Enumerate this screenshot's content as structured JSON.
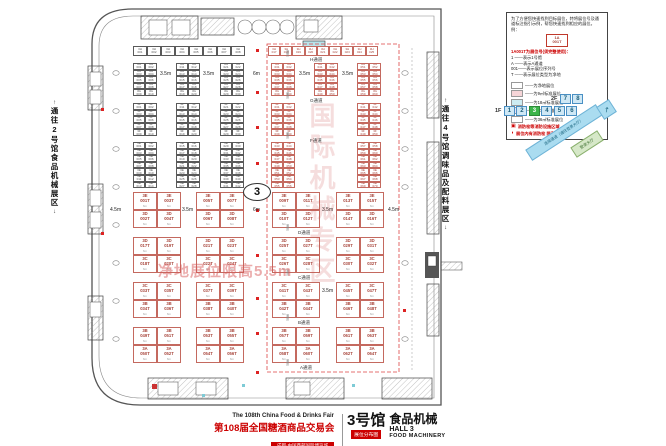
{
  "corridors": {
    "left": "通往2号馆食品机械展区",
    "right": "通往4号馆调味品及配料展区",
    "up": "↑",
    "down": "↓"
  },
  "watermarks": {
    "vertical": "国际机械专区",
    "horizontal": "净地展位限高5.5m"
  },
  "map": {
    "badge": "3",
    "small_blocks": [
      {
        "x": 133,
        "y": 46,
        "cols": 8,
        "rows": 1,
        "cw": 14,
        "ch": 10,
        "cls": "bk",
        "prefix": "3H",
        "start": 1
      },
      {
        "x": 268,
        "y": 46,
        "cols": 9,
        "rows": 1,
        "cw": 12.2,
        "ch": 10,
        "cls": "rd",
        "prefix": "3H",
        "start": 17
      },
      {
        "x": 133,
        "y": 63,
        "cols": 2,
        "rows": 5,
        "cw": 12,
        "ch": 6.6,
        "cls": "bk",
        "prefix": "3G",
        "start": 1
      },
      {
        "x": 176,
        "y": 63,
        "cols": 2,
        "rows": 5,
        "cw": 12,
        "ch": 6.6,
        "cls": "bk",
        "prefix": "3G",
        "start": 11
      },
      {
        "x": 220,
        "y": 63,
        "cols": 2,
        "rows": 5,
        "cw": 12,
        "ch": 6.6,
        "cls": "bk",
        "prefix": "3G",
        "start": 21
      },
      {
        "x": 271,
        "y": 63,
        "cols": 2,
        "rows": 5,
        "cw": 12,
        "ch": 6.6,
        "cls": "rd",
        "prefix": "3G",
        "start": 31
      },
      {
        "x": 314,
        "y": 63,
        "cols": 2,
        "rows": 5,
        "cw": 12,
        "ch": 6.6,
        "cls": "rd",
        "prefix": "3G",
        "start": 41
      },
      {
        "x": 357,
        "y": 63,
        "cols": 2,
        "rows": 5,
        "cw": 12,
        "ch": 6.6,
        "cls": "rd",
        "prefix": "3G",
        "start": 51
      },
      {
        "x": 133,
        "y": 103,
        "cols": 2,
        "rows": 5,
        "cw": 12,
        "ch": 6.6,
        "cls": "bk",
        "prefix": "3F",
        "start": 1
      },
      {
        "x": 176,
        "y": 103,
        "cols": 2,
        "rows": 5,
        "cw": 12,
        "ch": 6.6,
        "cls": "bk",
        "prefix": "3F",
        "start": 11
      },
      {
        "x": 220,
        "y": 103,
        "cols": 2,
        "rows": 5,
        "cw": 12,
        "ch": 6.6,
        "cls": "bk",
        "prefix": "3F",
        "start": 21
      },
      {
        "x": 271,
        "y": 103,
        "cols": 2,
        "rows": 5,
        "cw": 12,
        "ch": 6.6,
        "cls": "rd",
        "prefix": "3F",
        "start": 31
      },
      {
        "x": 357,
        "y": 103,
        "cols": 2,
        "rows": 5,
        "cw": 12,
        "ch": 6.6,
        "cls": "rd",
        "prefix": "3F",
        "start": 41
      },
      {
        "x": 133,
        "y": 142,
        "cols": 2,
        "rows": 7,
        "cw": 12,
        "ch": 6.6,
        "cls": "bk",
        "prefix": "3E",
        "start": 1
      },
      {
        "x": 176,
        "y": 142,
        "cols": 2,
        "rows": 7,
        "cw": 12,
        "ch": 6.6,
        "cls": "bk",
        "prefix": "3E",
        "start": 15
      },
      {
        "x": 220,
        "y": 142,
        "cols": 2,
        "rows": 7,
        "cw": 12,
        "ch": 6.6,
        "cls": "bk",
        "prefix": "3E",
        "start": 29
      },
      {
        "x": 271,
        "y": 142,
        "cols": 2,
        "rows": 7,
        "cw": 12,
        "ch": 6.6,
        "cls": "rd",
        "prefix": "3E",
        "start": 43
      },
      {
        "x": 357,
        "y": 142,
        "cols": 2,
        "rows": 7,
        "cw": 12,
        "ch": 6.6,
        "cls": "rd",
        "prefix": "3E",
        "start": 57
      }
    ],
    "big_cols": [
      133,
      157,
      196,
      220,
      272,
      296,
      336,
      360
    ],
    "big_w": 24,
    "big_h": 18,
    "big_size_note": "6m",
    "big_bands": [
      {
        "y": 192,
        "rows": [
          "3E",
          "3D"
        ],
        "base": 1
      },
      {
        "y": 237,
        "rows": [
          "3D",
          "3C"
        ],
        "base": 17
      },
      {
        "y": 282,
        "rows": [
          "3C",
          "3B"
        ],
        "base": 33
      },
      {
        "y": 327,
        "rows": [
          "3B",
          "3A"
        ],
        "base": 49
      }
    ],
    "aisles": [
      {
        "label": "H通道",
        "x": 310,
        "y": 57
      },
      {
        "label": "G通道",
        "x": 310,
        "y": 98
      },
      {
        "label": "F通道",
        "x": 310,
        "y": 138
      },
      {
        "label": "D通道",
        "x": 298,
        "y": 230
      },
      {
        "label": "C通道",
        "x": 298,
        "y": 275
      },
      {
        "label": "B通道",
        "x": 298,
        "y": 320
      },
      {
        "label": "A通道",
        "x": 300,
        "y": 365
      },
      {
        "label": "通道",
        "x": 285,
        "y": 50,
        "rot": true
      },
      {
        "label": "通道",
        "x": 285,
        "y": 92,
        "rot": true
      },
      {
        "label": "通道",
        "x": 285,
        "y": 132,
        "rot": true
      },
      {
        "label": "通道",
        "x": 285,
        "y": 224,
        "rot": true
      },
      {
        "label": "通道",
        "x": 285,
        "y": 269,
        "rot": true
      },
      {
        "label": "通道",
        "x": 285,
        "y": 314,
        "rot": true
      },
      {
        "label": "通道",
        "x": 285,
        "y": 359,
        "rot": true
      }
    ],
    "dims": [
      {
        "t": "3.5m",
        "x": 160,
        "y": 71
      },
      {
        "t": "3.5m",
        "x": 203,
        "y": 71
      },
      {
        "t": "6m",
        "x": 253,
        "y": 71
      },
      {
        "t": "3.5m",
        "x": 299,
        "y": 71
      },
      {
        "t": "3.5m",
        "x": 342,
        "y": 71
      },
      {
        "t": "4.5m",
        "x": 110,
        "y": 207
      },
      {
        "t": "3.5m",
        "x": 182,
        "y": 207
      },
      {
        "t": "6m",
        "x": 253,
        "y": 207
      },
      {
        "t": "3.5m",
        "x": 322,
        "y": 207
      },
      {
        "t": "4.5m",
        "x": 388,
        "y": 207
      },
      {
        "t": "3.5m",
        "x": 322,
        "y": 288
      }
    ]
  },
  "legend": {
    "intro": "为了方便您快速找到目标展位，特将展位号及通道标注指引示例，帮您快速找到相应的展位。例：",
    "sample": {
      "line1": "1A",
      "line2": "001T"
    },
    "heading": "1A001T为展位号(须完整使用)：",
    "rules": [
      "1 ——表示1号馆",
      "A ——表示A通道",
      "001——表示展位序列号",
      "T ——表示展位类型为净地"
    ],
    "swatches": [
      {
        "color": "#ffffff",
        "label": "——为净地展位"
      },
      {
        "color": "#f6d5d8",
        "label": "——为9㎡标准展位"
      },
      {
        "color": "#cdecf2",
        "label": "——为18㎡标准展位"
      },
      {
        "color": "#e9e2f4",
        "label": "——为27㎡标准展位"
      },
      {
        "color": "#ffffff",
        "label": "——为36㎡标准展位"
      }
    ],
    "notes": [
      {
        "icon": "▣",
        "label": "消防栓等消防设施区域"
      },
      {
        "icon": "◗",
        "label": "展位内有消防栓 限高1.5m"
      }
    ]
  },
  "locator": {
    "floors": [
      {
        "name": "2F",
        "cells": [
          {
            "label": "7"
          },
          {
            "label": "8"
          }
        ]
      },
      {
        "name": "1F",
        "cells": [
          {
            "label": "1"
          },
          {
            "label": "2"
          },
          {
            "label": "3",
            "active": true
          },
          {
            "label": "4"
          },
          {
            "label": "5"
          },
          {
            "label": "6"
          }
        ]
      }
    ],
    "active_color": "#3cb54a",
    "ribbon": "连接通道（通往登录大厅）",
    "arrow": "↗",
    "tag": "登录大厅"
  },
  "title_block": {
    "fair_en": "The 108th China Food & Drinks Fair",
    "fair_cn": "第108届全国糖酒商品交易会",
    "venue": "成都·中国西部国际博览城",
    "hall_cn": "3号馆",
    "hall_tag": "展位分布图",
    "category_cn": "食品机械",
    "hall_en": "HALL 3",
    "category_en": "FOOD MACHINERY",
    "accent": "#cc0000"
  }
}
